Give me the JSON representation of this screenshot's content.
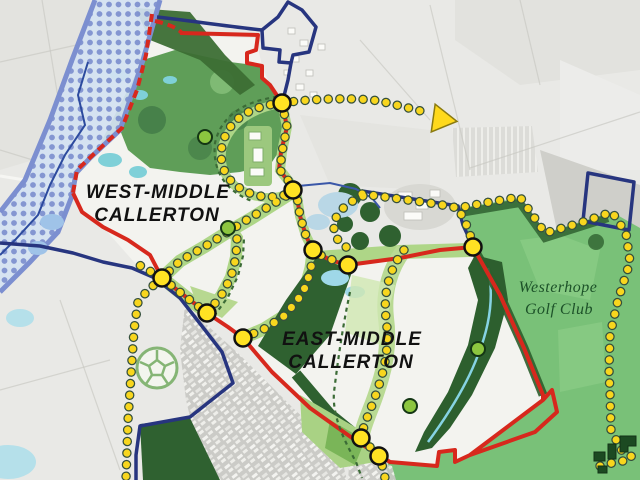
{
  "map": {
    "labels": {
      "west_site": {
        "line1": "WEST-MIDDLE",
        "line2": "CALLERTON"
      },
      "east_site": {
        "line1": "EAST-MIDDLE",
        "line2": "CALLERTON"
      },
      "golf_club": {
        "line1": "Westerhope",
        "line2": "Golf Club"
      }
    },
    "colors": {
      "red_boundary": "#d7281d",
      "blue_boundary": "#27357f",
      "flood_band_border": "#7c8fd0",
      "flood_band_fill": "#d4e2f2",
      "route_dot": "#f8d61e",
      "route_node_fill": "#ffe223",
      "green_marker_fill": "#8cc63f",
      "golf_green": "#79c178",
      "woodland_green": "#2f6130",
      "corridor_green": "#aed687",
      "pond_cyan": "#9fd8e8"
    },
    "icons": {
      "football_pitch": "football-pitch-icon",
      "direction_arrow": "direction-arrow-icon",
      "buildings": "buildings-icon",
      "route_node": "route-node-marker",
      "green_space_marker": "green-space-marker"
    }
  }
}
